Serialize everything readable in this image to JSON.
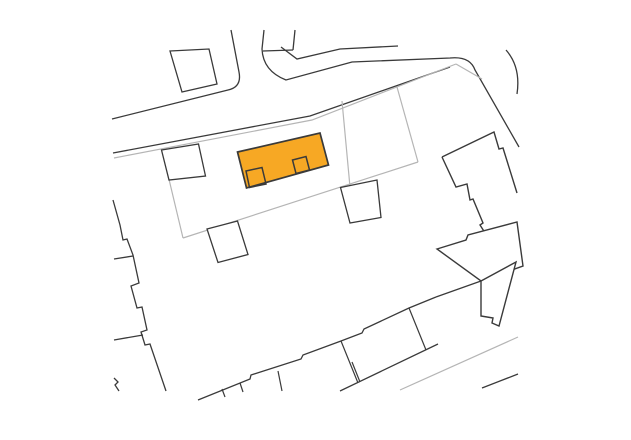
{
  "canvas": {
    "width": 631,
    "height": 440,
    "background": "#ffffff"
  },
  "map": {
    "type": "cadastral-site-plan",
    "highlight_color": "#f7a824",
    "building_line_color": "#3a3a3a",
    "parcel_line_color": "#b5b5b5",
    "features": [
      {
        "name": "road-north-edge-and-side-street-left",
        "kind": "road-edge",
        "stroke": "#3a3a3a",
        "width": 1.3,
        "fill": "none",
        "d": "M112,119 L228,90 Q242,87 239,72 L231,30"
      },
      {
        "name": "road-side-street-right-north-edge-east-and-turn",
        "kind": "road-edge",
        "stroke": "#3a3a3a",
        "width": 1.3,
        "fill": "none",
        "d": "M264,30 L262,49 Q263,71 286,80 Q330,68 352,62 L450,58 Q470,56 475,70 L519,147"
      },
      {
        "name": "road-south-edge",
        "kind": "road-edge",
        "stroke": "#3a3a3a",
        "width": 1.3,
        "fill": "none",
        "d": "M113,153 L310,116 L450,67"
      },
      {
        "name": "road-east-branch-edge",
        "kind": "road-edge",
        "stroke": "#3a3a3a",
        "width": 1.3,
        "fill": "none",
        "d": "M506,50 Q521,67 517,94"
      },
      {
        "name": "parcel-corner-cut",
        "kind": "parcel-boundary",
        "stroke": "#b5b5b5",
        "width": 1.2,
        "fill": "none",
        "d": "M456,64 L482,79"
      },
      {
        "name": "parcel-top-boundary",
        "kind": "parcel-boundary",
        "stroke": "#b5b5b5",
        "width": 1.2,
        "fill": "none",
        "d": "M114,158 L312,120 L456,64"
      },
      {
        "name": "parcel-left-boundary",
        "kind": "parcel-boundary",
        "stroke": "#b5b5b5",
        "width": 1.2,
        "fill": "none",
        "d": "M162,150 L183,238"
      },
      {
        "name": "parcel-bottom-boundary",
        "kind": "parcel-boundary",
        "stroke": "#b5b5b5",
        "width": 1.2,
        "fill": "none",
        "d": "M183,238 L418,162"
      },
      {
        "name": "parcel-right-boundary",
        "kind": "parcel-boundary",
        "stroke": "#b5b5b5",
        "width": 1.2,
        "fill": "none",
        "d": "M397,87 L418,162"
      },
      {
        "name": "parcel-divider",
        "kind": "parcel-boundary",
        "stroke": "#b5b5b5",
        "width": 1.2,
        "fill": "none",
        "d": "M342,101 L350,187"
      },
      {
        "name": "parcel-line-bottom-right",
        "kind": "parcel-boundary",
        "stroke": "#b5b5b5",
        "width": 1.2,
        "fill": "none",
        "d": "M400,390 L518,337"
      },
      {
        "name": "building-north-west",
        "kind": "building",
        "stroke": "#3a3a3a",
        "width": 1.3,
        "fill": "#ffffff",
        "d": "M170,51 L209,49 L217,84 L182,92 Z"
      },
      {
        "name": "building-north-wall-a",
        "kind": "building",
        "stroke": "#3a3a3a",
        "width": 1.3,
        "fill": "none",
        "d": "M263,51 L293,50"
      },
      {
        "name": "building-north-wall-b",
        "kind": "building",
        "stroke": "#3a3a3a",
        "width": 1.3,
        "fill": "none",
        "d": "M295,30 L293,50"
      },
      {
        "name": "building-north-front-line",
        "kind": "building",
        "stroke": "#3a3a3a",
        "width": 1.3,
        "fill": "none",
        "d": "M281,47 L297,59 L340,49 L398,46"
      },
      {
        "name": "building-west-stepped-edge",
        "kind": "building",
        "stroke": "#3a3a3a",
        "width": 1.3,
        "fill": "none",
        "d": "M113,200 L120,225 L123,240 L127,239 L133,255 L139,283 L131,286 L137,308 L142,307 L147,330 L141,332 L145,345 L150,344 L166,391"
      },
      {
        "name": "building-west-stub-upper",
        "kind": "building",
        "stroke": "#3a3a3a",
        "width": 1.3,
        "fill": "none",
        "d": "M133,256 L114,259"
      },
      {
        "name": "building-west-stub-lower",
        "kind": "building",
        "stroke": "#3a3a3a",
        "width": 1.3,
        "fill": "none",
        "d": "M143,335 L114,340"
      },
      {
        "name": "building-west-corner-mark",
        "kind": "building",
        "stroke": "#3a3a3a",
        "width": 1.3,
        "fill": "none",
        "d": "M114,378 L118,382 L115,385 L119,391"
      },
      {
        "name": "outbuilding-left",
        "kind": "building",
        "stroke": "#3a3a3a",
        "width": 1.3,
        "fill": "#ffffff",
        "d": "M161.5,150 L198.5,144 L205.5,176 L169,180 Z"
      },
      {
        "name": "outbuilding-right",
        "kind": "building",
        "stroke": "#3a3a3a",
        "width": 1.3,
        "fill": "#ffffff",
        "d": "M340.5,187.5 L377,180 L381,217.5 L350,223 Z"
      },
      {
        "name": "outbuilding-bottom",
        "kind": "building",
        "stroke": "#3a3a3a",
        "width": 1.3,
        "fill": "#ffffff",
        "d": "M207,229 L237.5,221 L248,254.5 L218,262.5 Z"
      },
      {
        "name": "east-complex-upper-outline-right",
        "kind": "building",
        "stroke": "#3a3a3a",
        "width": 1.4,
        "fill": "none",
        "d": "M442,157 L494,132 L499,149 L503,148 L517,193"
      },
      {
        "name": "east-complex-upper-outline-left",
        "kind": "building",
        "stroke": "#3a3a3a",
        "width": 1.4,
        "fill": "none",
        "d": "M442,157 L456,187 L467,184 L470,200 L473,199 L483,223 L480,225 L487,236"
      },
      {
        "name": "east-complex-middle-block",
        "kind": "building",
        "stroke": "#3a3a3a",
        "width": 1.4,
        "fill": "#ffffff",
        "d": "M437,249 L466,240 L468,235 L517,222 L523,266 L481,281 Z"
      },
      {
        "name": "east-complex-lower-block",
        "kind": "building",
        "stroke": "#3a3a3a",
        "width": 1.4,
        "fill": "#ffffff",
        "d": "M481,281 L516,262 L499,326 L492,323 L493,318 L481,316 Z"
      },
      {
        "name": "east-complex-long-wall",
        "kind": "building",
        "stroke": "#3a3a3a",
        "width": 1.3,
        "fill": "none",
        "d": "M481,281 L436,297"
      },
      {
        "name": "terrace-row-nw-edge",
        "kind": "building",
        "stroke": "#3a3a3a",
        "width": 1.3,
        "fill": "none",
        "d": "M198,400 L250,379 L251,375 L301,359 L303,355 L341,341 L362,333 L364,329 L409,308 L436,297"
      },
      {
        "name": "terrace-row-se-edge",
        "kind": "building",
        "stroke": "#3a3a3a",
        "width": 1.3,
        "fill": "none",
        "d": "M340,391 L438,344"
      },
      {
        "name": "terrace-division-1",
        "kind": "building",
        "stroke": "#3a3a3a",
        "width": 1.2,
        "fill": "none",
        "d": "M222,389 L225,397"
      },
      {
        "name": "terrace-division-2",
        "kind": "building",
        "stroke": "#3a3a3a",
        "width": 1.2,
        "fill": "none",
        "d": "M240,383 L243,392"
      },
      {
        "name": "terrace-division-3",
        "kind": "building",
        "stroke": "#3a3a3a",
        "width": 1.2,
        "fill": "none",
        "d": "M278,371 L282,391"
      },
      {
        "name": "terrace-division-4",
        "kind": "building",
        "stroke": "#3a3a3a",
        "width": 1.2,
        "fill": "none",
        "d": "M341,341 L358,383"
      },
      {
        "name": "terrace-division-5",
        "kind": "building",
        "stroke": "#3a3a3a",
        "width": 1.2,
        "fill": "none",
        "d": "M352,362 L360,382"
      },
      {
        "name": "terrace-division-6",
        "kind": "building",
        "stroke": "#3a3a3a",
        "width": 1.2,
        "fill": "none",
        "d": "M409,308 L426,350"
      },
      {
        "name": "boundary-line-bottom-right",
        "kind": "building",
        "stroke": "#3a3a3a",
        "width": 1.3,
        "fill": "none",
        "d": "M482,388 L518,374"
      },
      {
        "name": "highlighted-building",
        "kind": "highlight-building",
        "stroke": "#3a3a3a",
        "width": 1.7,
        "fill": "#f7a824",
        "d": "M237.5,152 L320,133 L328.5,165 L246.5,188 Z"
      },
      {
        "name": "highlighted-building-annex-left",
        "kind": "highlight-annex",
        "stroke": "#3a3a3a",
        "width": 1.5,
        "fill": "none",
        "d": "M246,171 L262,167.5 L266,184 L249.5,187.5 Z"
      },
      {
        "name": "highlighted-building-annex-right",
        "kind": "highlight-annex",
        "stroke": "#3a3a3a",
        "width": 1.5,
        "fill": "none",
        "d": "M292.5,160 L306,156.5 L309.5,170 L296,173.5 Z"
      }
    ]
  }
}
